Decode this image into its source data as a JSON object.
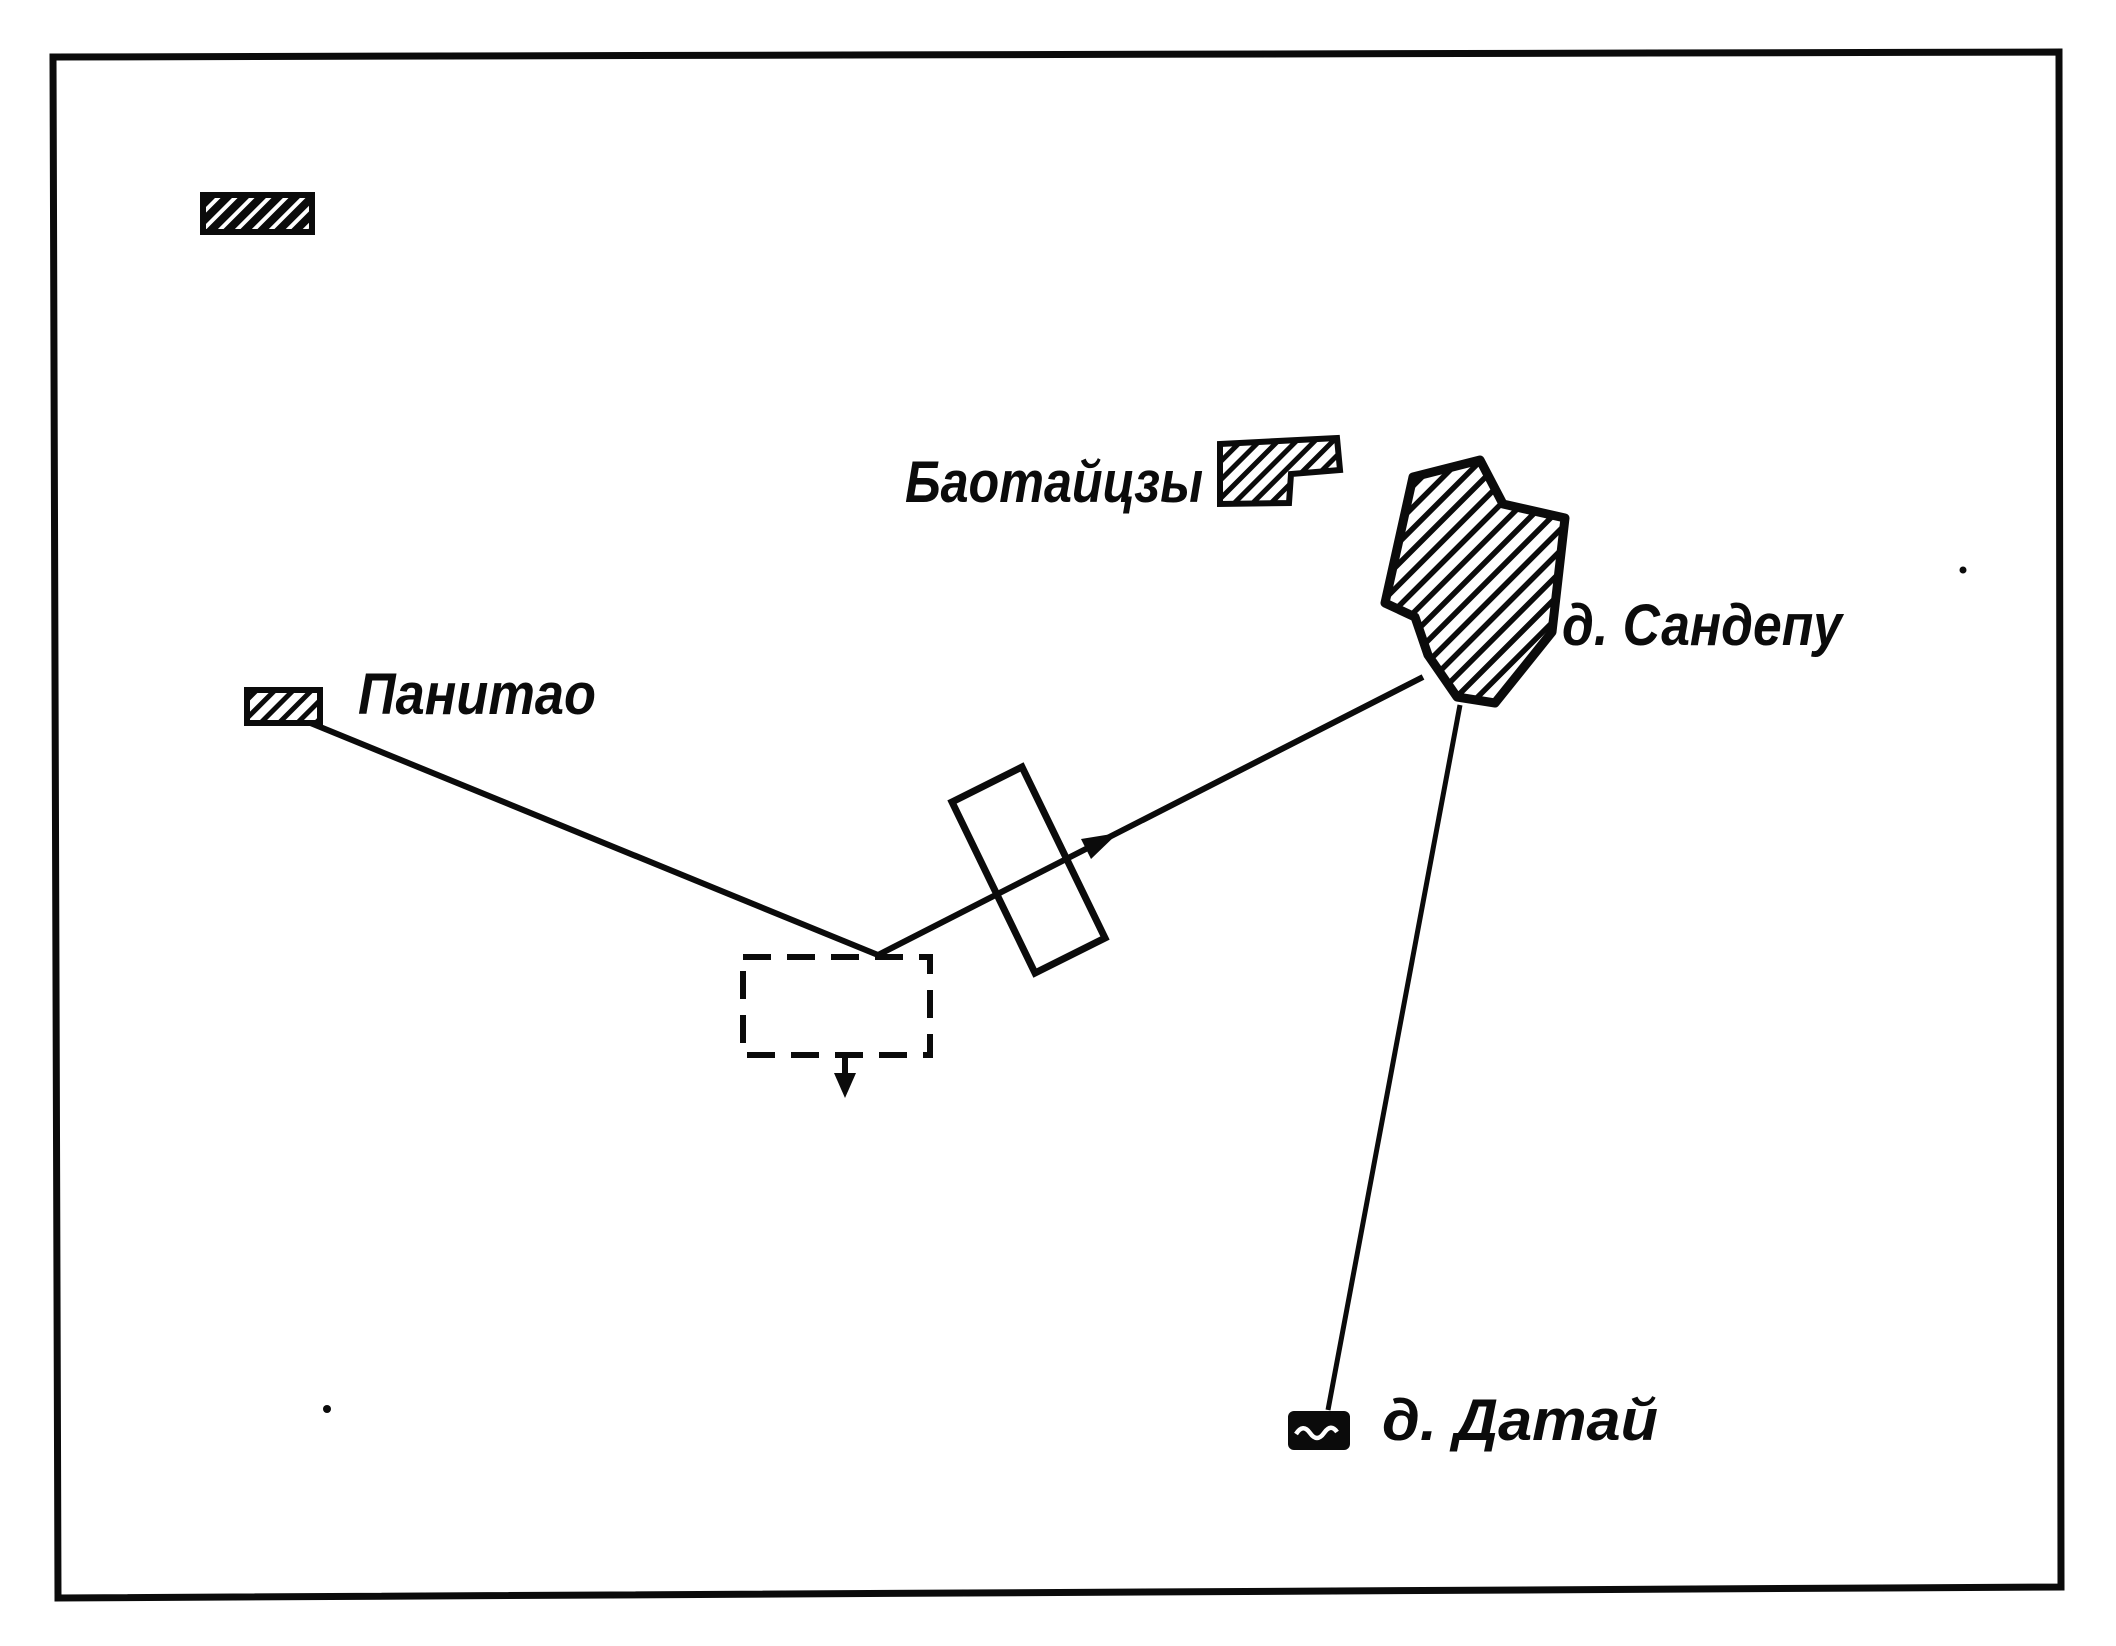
{
  "page": {
    "background_color": "#ffffff",
    "ink_color": "#0b0b0b",
    "kind": "scanned hand-drawn tactical sketch map"
  },
  "map": {
    "labels": {
      "baotaitszy": "Баотайцзы",
      "sandepu": "д. Сандепу",
      "panitao": "Панитао",
      "datai": "д. Датай"
    },
    "features": {
      "villages": [
        "Баотайцзы",
        "д. Сандепу",
        "Панитао",
        "д. Датай"
      ],
      "symbols": [
        "hatched village outlines",
        "dashed unit rectangle with down arrow",
        "rotated rectangle crossed by arrowed route line"
      ]
    }
  }
}
